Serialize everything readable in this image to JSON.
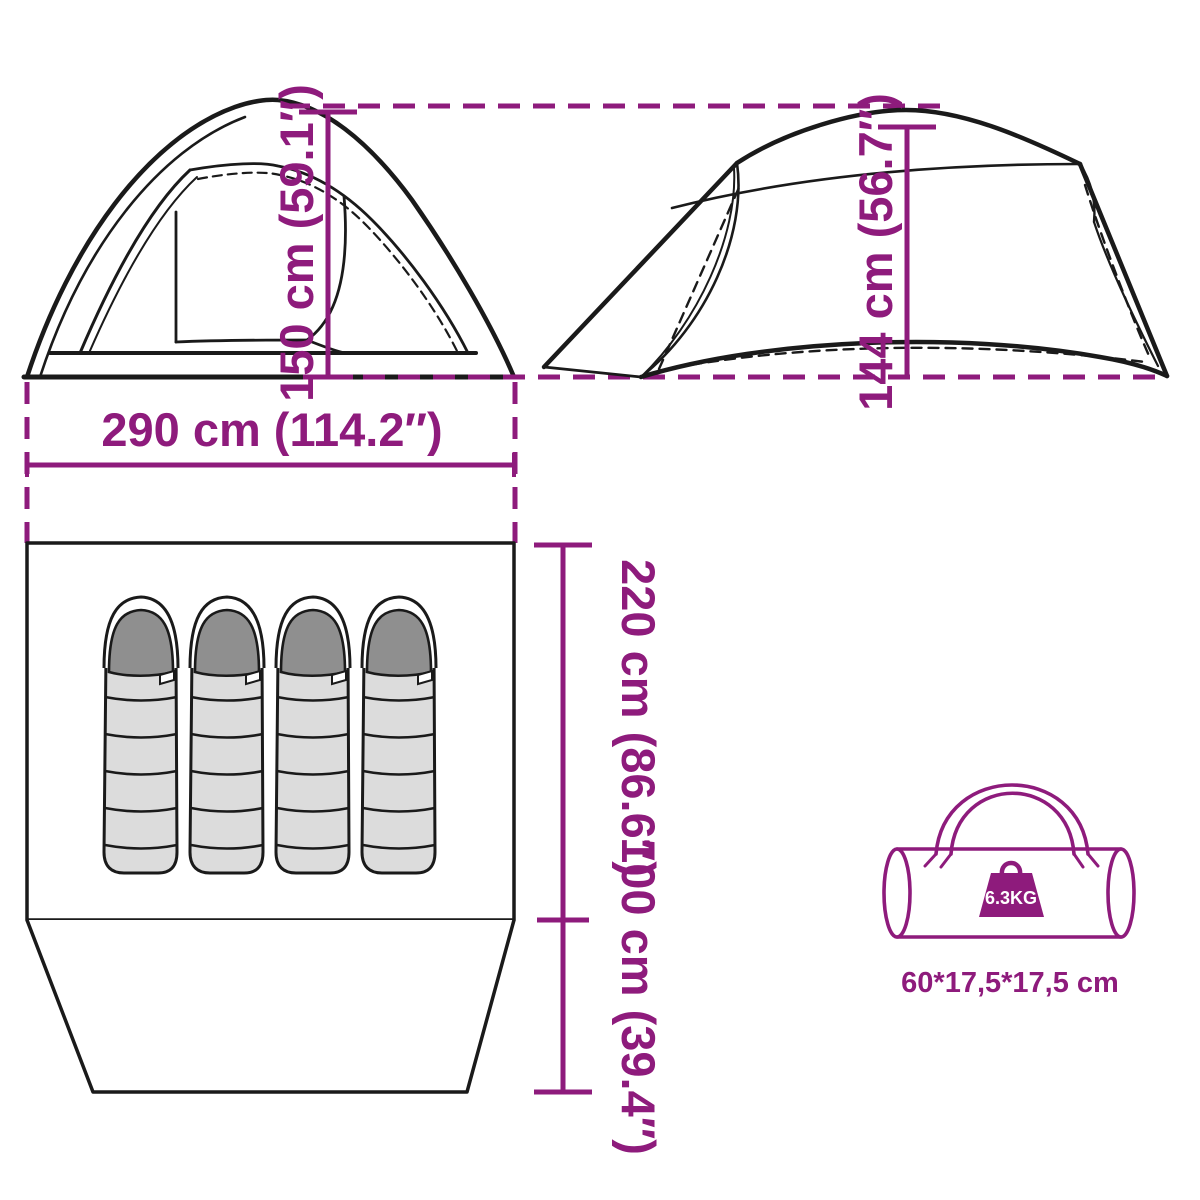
{
  "diagram_title": "tent-dimensions-diagram",
  "colors": {
    "accent": "#8E1B7C",
    "line": "#1A1A1A",
    "bag_body": "#DCDCDC",
    "bag_hood": "#8F8F8F"
  },
  "front_view": {
    "height_label": "150 cm (59.1″)",
    "width_label": "290 cm (114.2″)"
  },
  "side_view": {
    "height_label": "144 cm (56.7″)"
  },
  "floor_plan": {
    "inner_length_label": "220 cm (86.6″)",
    "porch_length_label": "100 cm (39.4″)",
    "sleeping_bag_count": 4
  },
  "carry_bag": {
    "weight_label": "6.3KG",
    "size_label": "60*17,5*17,5 cm"
  }
}
